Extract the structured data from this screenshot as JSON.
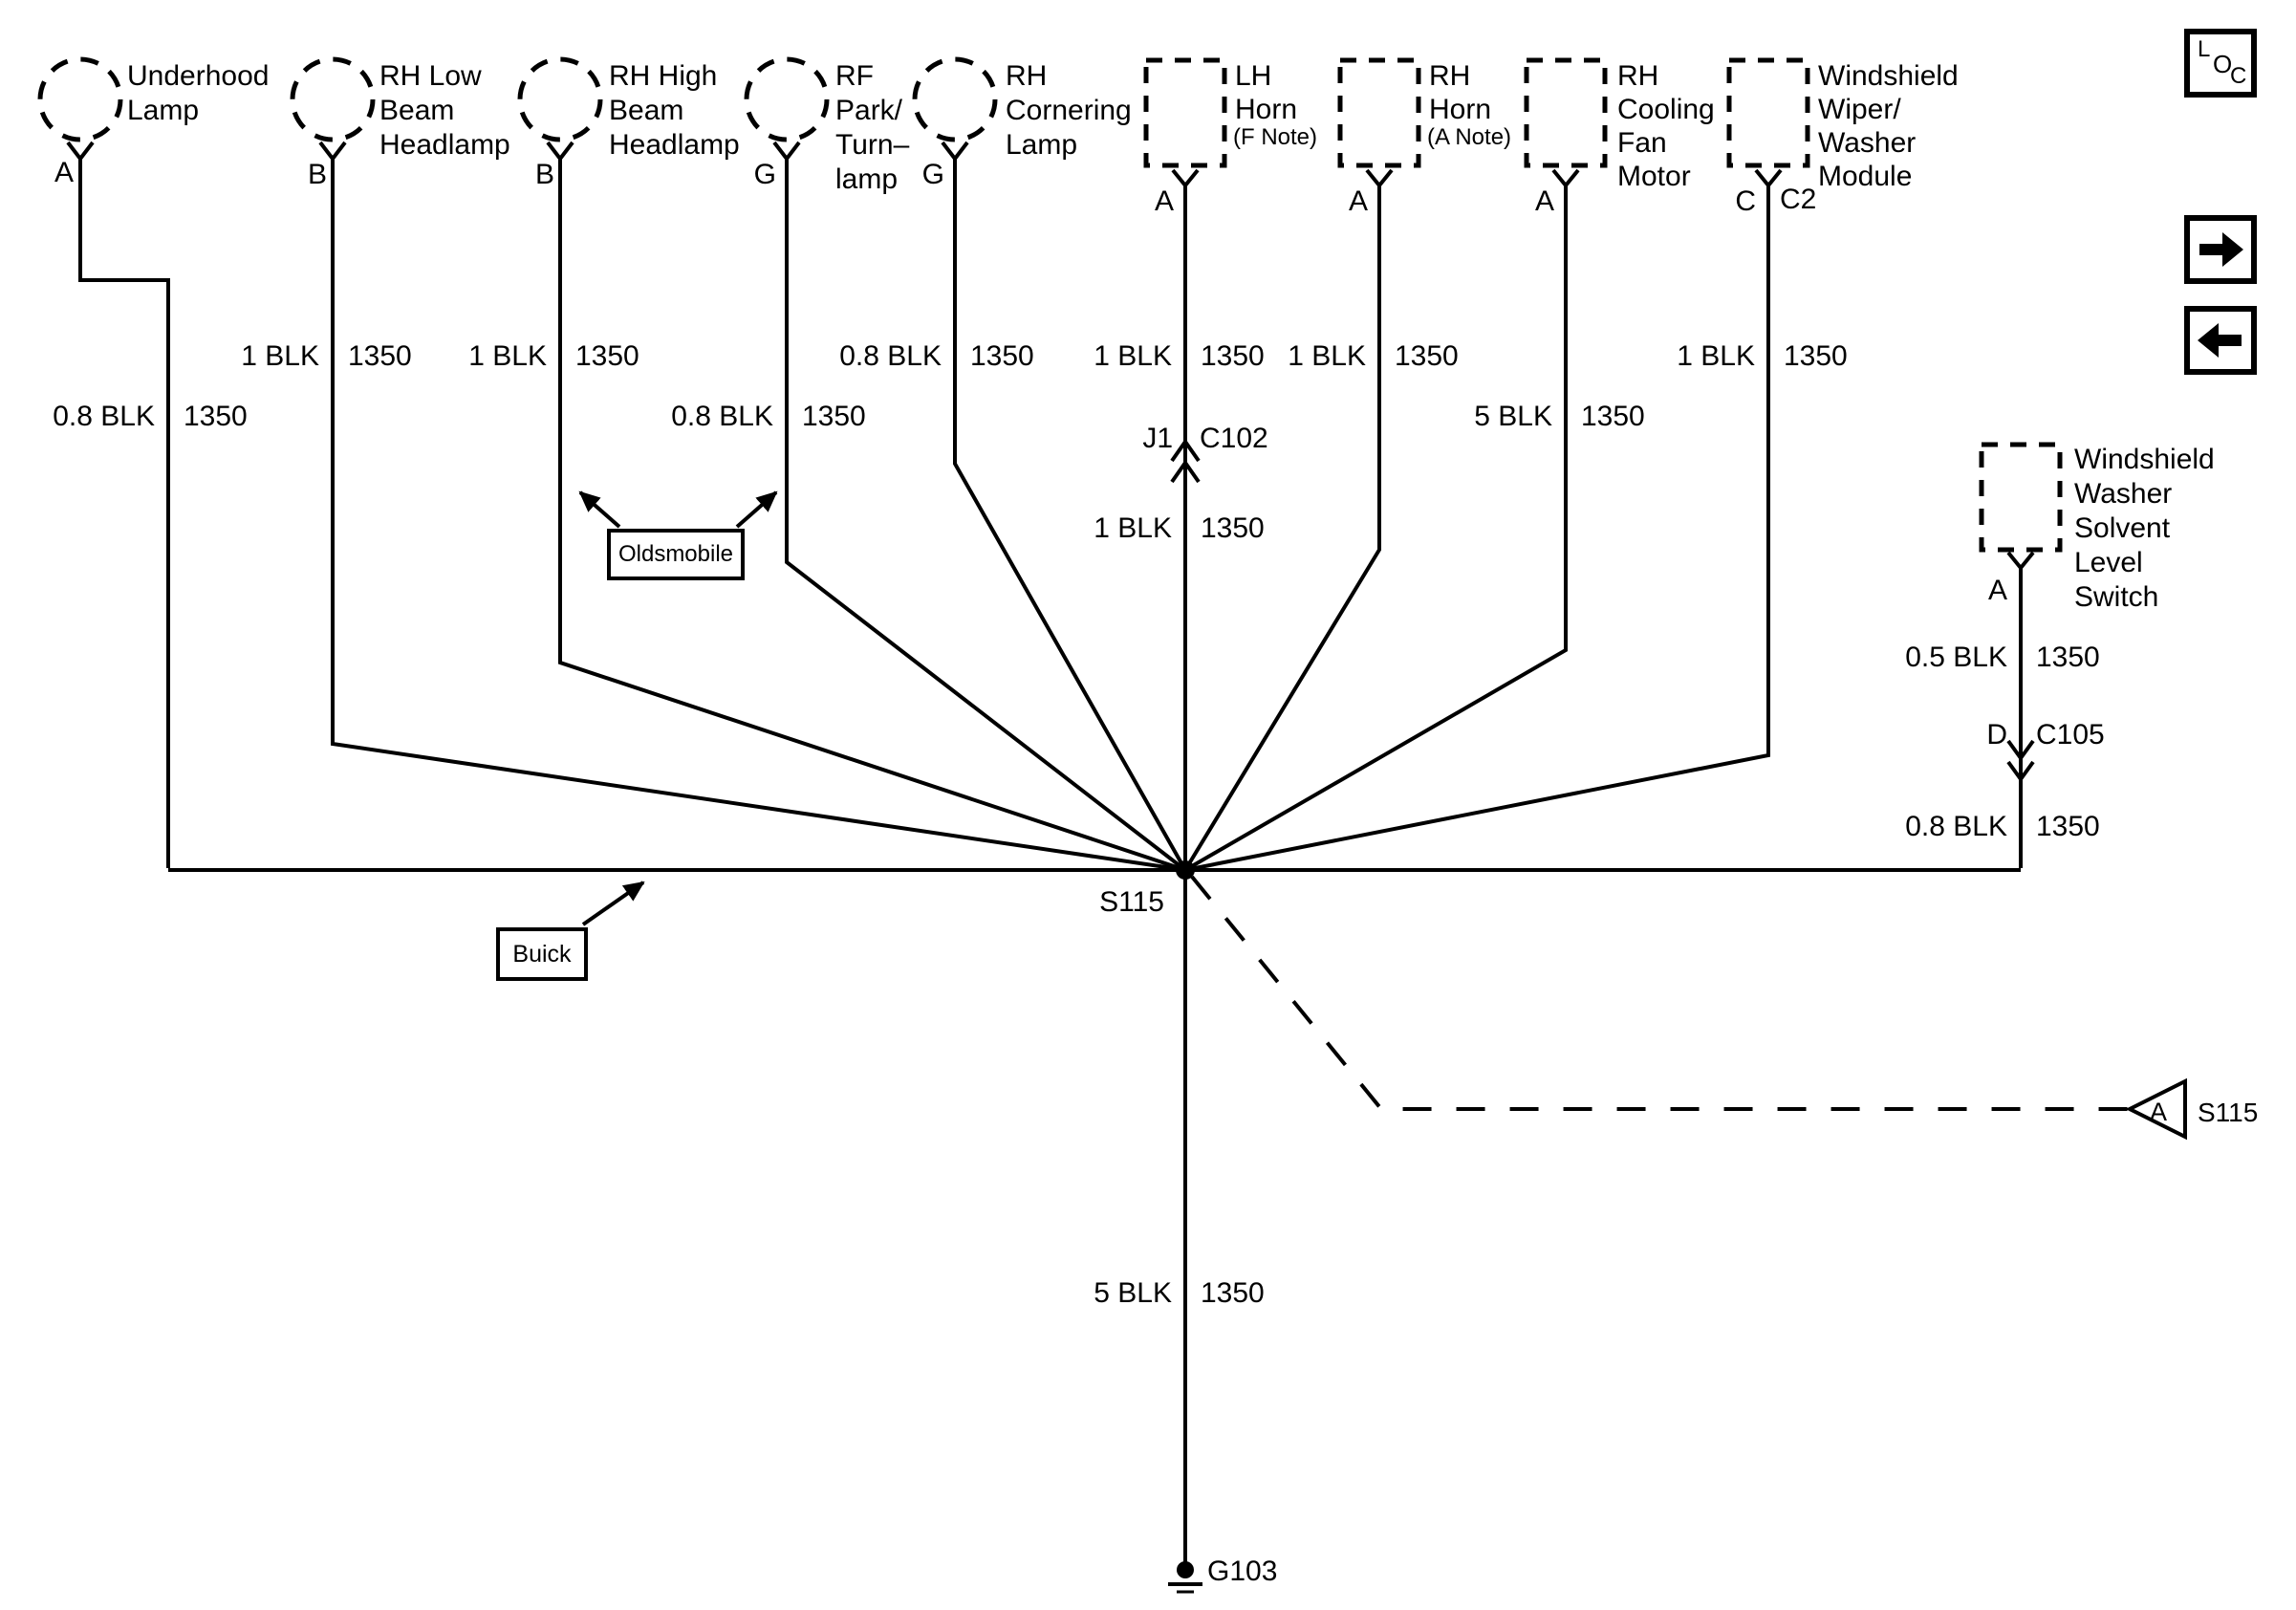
{
  "diagram_title": "Ground Distribution Schematic",
  "toolbar": {
    "loc_letters": {
      "l": "L",
      "o": "O",
      "c": "C"
    },
    "next_icon": "right-arrow",
    "prev_icon": "left-arrow"
  },
  "components": [
    {
      "name": "Underhood Lamp",
      "lines": [
        "Underhood",
        "Lamp"
      ],
      "pin": "A"
    },
    {
      "name": "RH Low Beam Headlamp",
      "lines": [
        "RH Low",
        "Beam",
        "Headlamp"
      ],
      "pin": "B"
    },
    {
      "name": "RH High Beam Headlamp",
      "lines": [
        "RH High",
        "Beam",
        "Headlamp"
      ],
      "pin": "B"
    },
    {
      "name": "RF Park/Turn-lamp",
      "lines": [
        "RF",
        "Park/",
        "Turn–",
        "lamp"
      ],
      "pin": "G"
    },
    {
      "name": "RH Cornering Lamp",
      "lines": [
        "RH",
        "Cornering",
        "Lamp"
      ],
      "pin": "G"
    },
    {
      "name": "LH Horn",
      "lines": [
        "LH",
        "Horn"
      ],
      "note": "(F Note)",
      "pin": "A"
    },
    {
      "name": "RH Horn",
      "lines": [
        "RH",
        "Horn"
      ],
      "note": "(A Note)",
      "pin": "A"
    },
    {
      "name": "RH Cooling Fan Motor",
      "lines": [
        "RH",
        "Cooling",
        "Fan",
        "Motor"
      ],
      "pin": "A"
    },
    {
      "name": "Windshield Wiper/Washer Module",
      "lines": [
        "Windshield",
        "Wiper/",
        "Washer",
        "Module"
      ],
      "pin": "C",
      "pin2": "C2"
    },
    {
      "name": "Windshield Washer Solvent Level Switch",
      "lines": [
        "Windshield",
        "Washer",
        "Solvent",
        "Level",
        "Switch"
      ],
      "pin": "A"
    }
  ],
  "wires": {
    "underhood": {
      "gauge": "0.8 BLK",
      "circuit": "1350"
    },
    "rh_low_beam": {
      "gauge": "1 BLK",
      "circuit": "1350"
    },
    "rh_high_beam": {
      "gauge": "1 BLK",
      "circuit": "1350"
    },
    "rf_park_turn": {
      "gauge": "0.8 BLK",
      "circuit": "1350"
    },
    "rh_cornering": {
      "gauge": "0.8 BLK",
      "circuit": "1350"
    },
    "lh_horn_above_c102": {
      "gauge": "1 BLK",
      "circuit": "1350"
    },
    "lh_horn_below_c102": {
      "gauge": "1 BLK",
      "circuit": "1350"
    },
    "rh_horn": {
      "gauge": "1 BLK",
      "circuit": "1350"
    },
    "cooling_fan": {
      "gauge": "5 BLK",
      "circuit": "1350"
    },
    "wiper_module": {
      "gauge": "1 BLK",
      "circuit": "1350"
    },
    "washer_above_c105": {
      "gauge": "0.5 BLK",
      "circuit": "1350"
    },
    "washer_below_c105": {
      "gauge": "0.8 BLK",
      "circuit": "1350"
    },
    "splice_to_ground": {
      "gauge": "5 BLK",
      "circuit": "1350"
    }
  },
  "connectors": {
    "c102": {
      "pin": "J1",
      "name": "C102"
    },
    "c105": {
      "pin": "D",
      "name": "C105"
    }
  },
  "splice": {
    "name": "S115"
  },
  "ground": {
    "name": "G103"
  },
  "offpage_reference": {
    "pin": "A",
    "name": "S115"
  },
  "callouts": {
    "oldsmobile": "Oldsmobile",
    "buick": "Buick"
  },
  "colors": {
    "line": "#000000",
    "background": "#ffffff"
  }
}
